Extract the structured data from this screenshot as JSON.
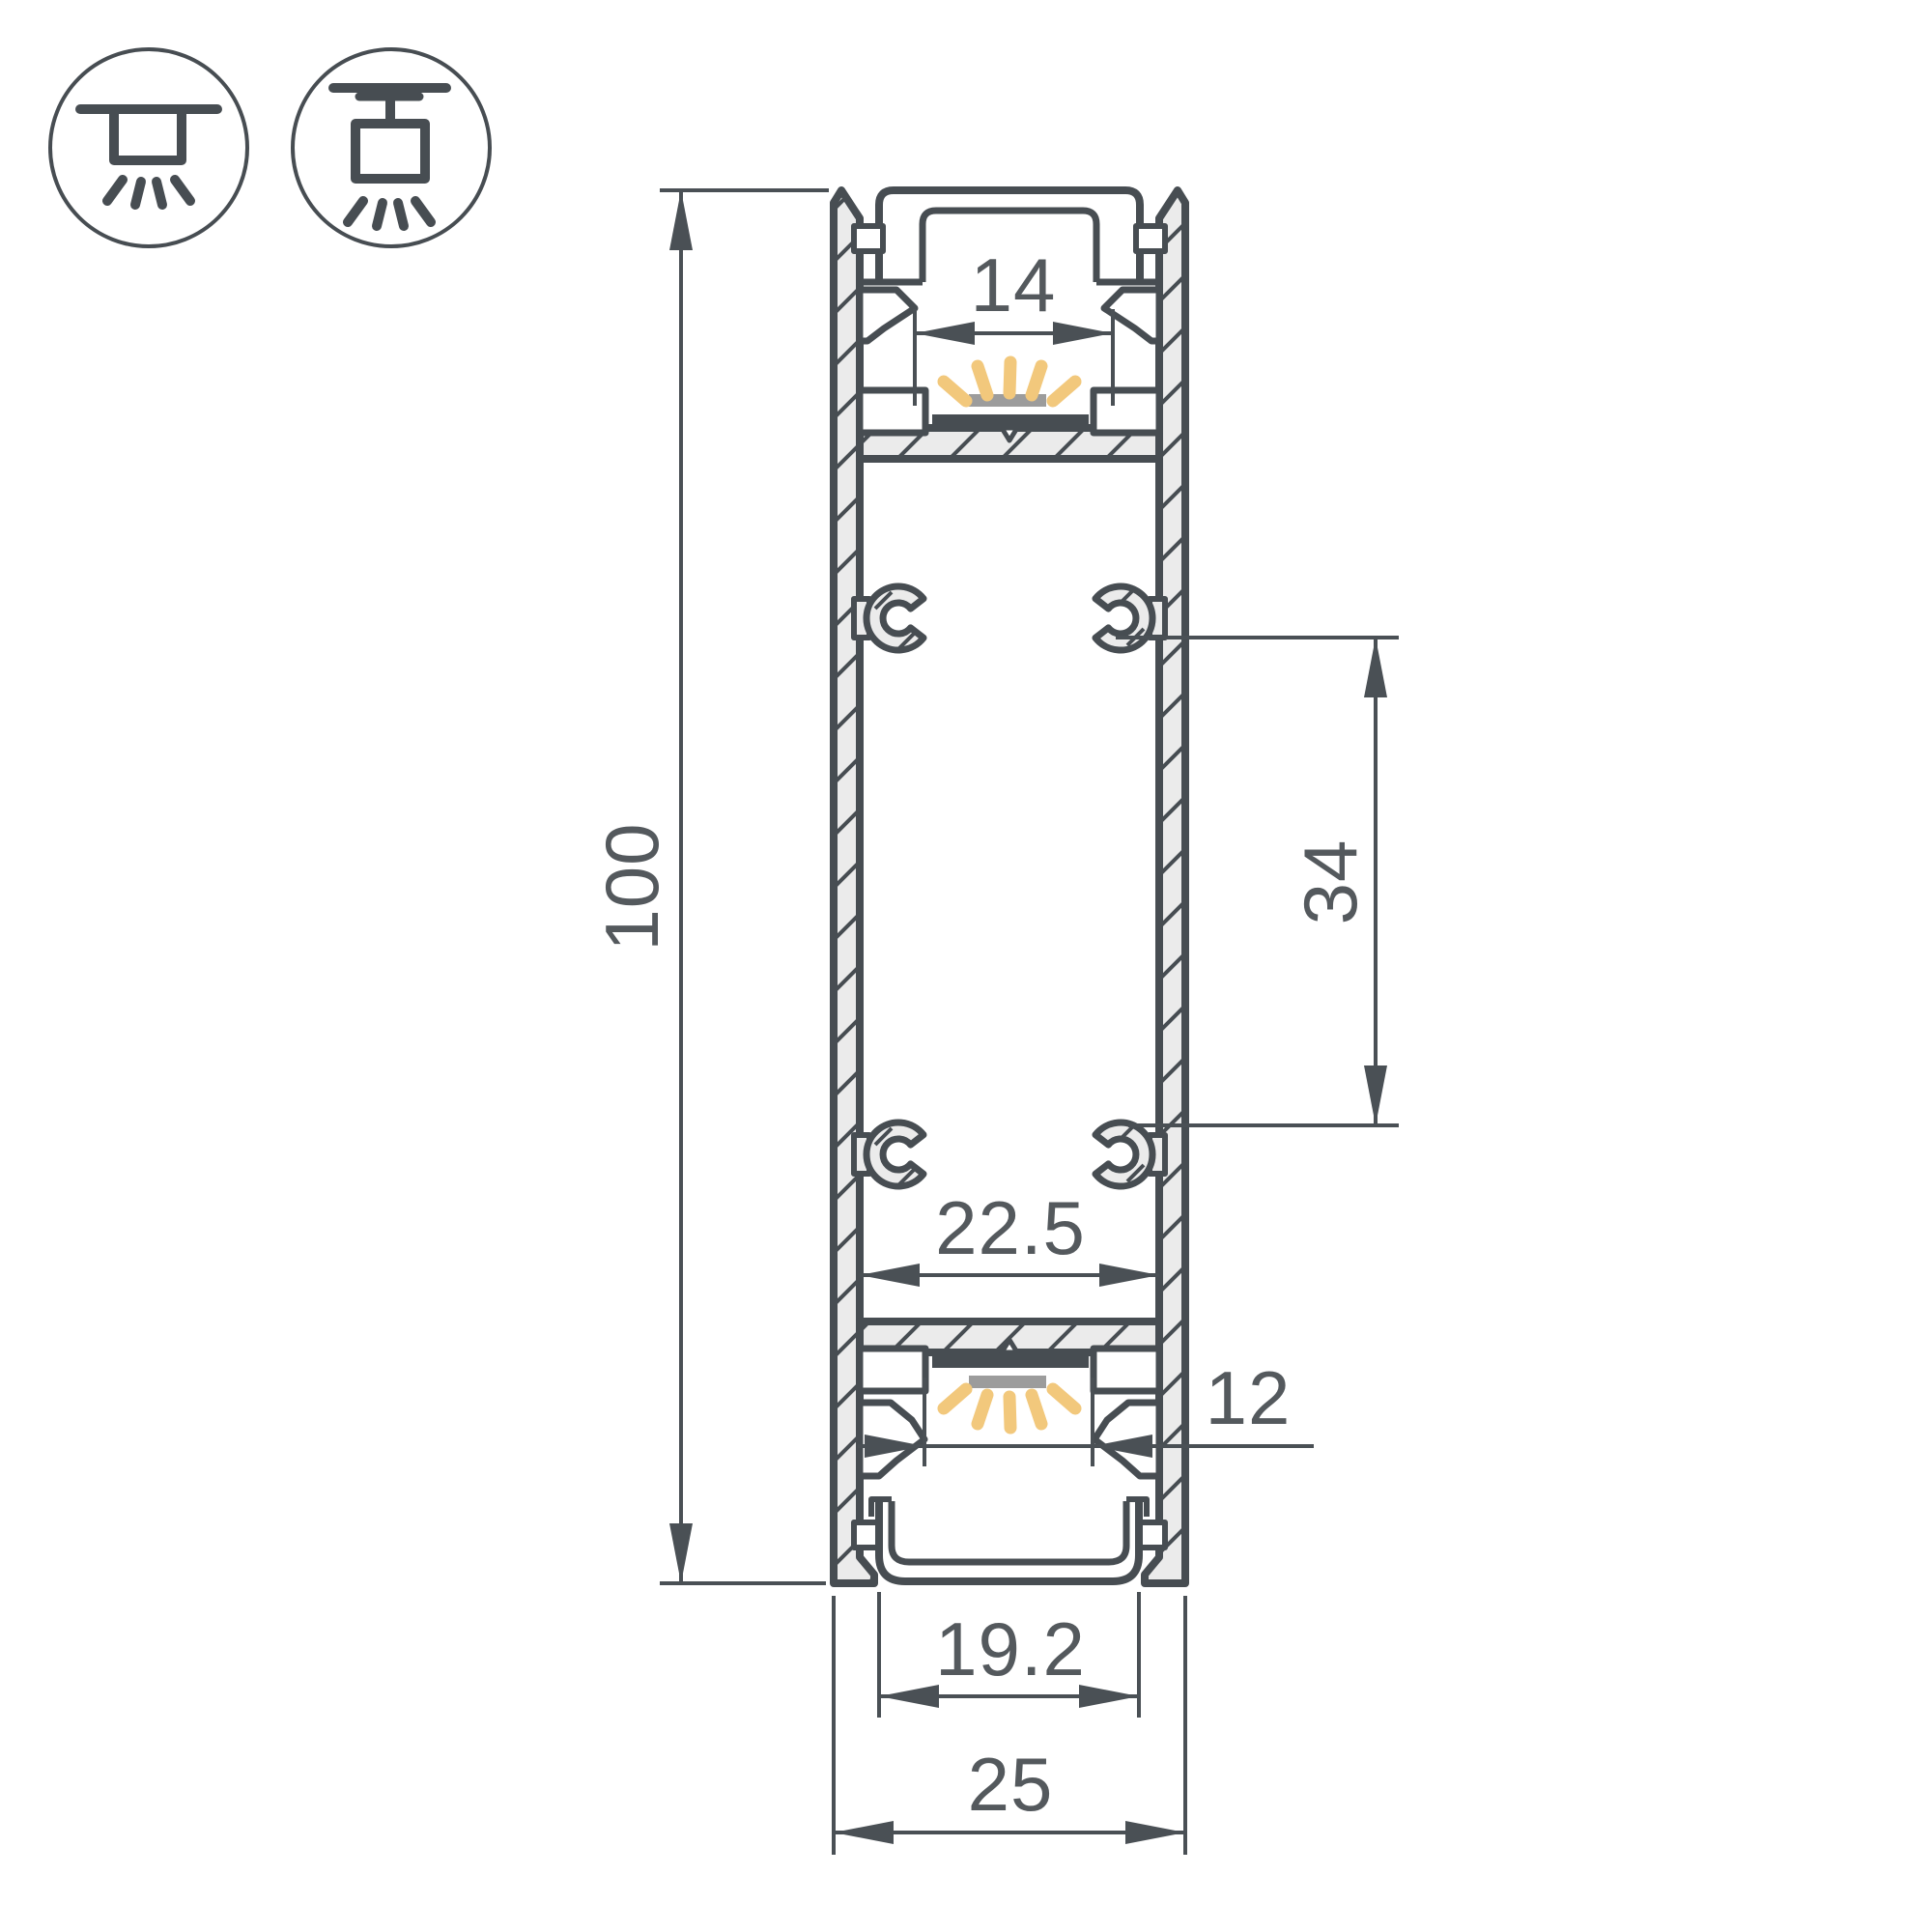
{
  "drawing": {
    "type": "technical-cross-section",
    "subject": "aluminium LED profile, double-sided (up/down light)",
    "dimensions": {
      "height": "100",
      "top_opening": "14",
      "mount_spacing": "34",
      "inner_width": "22.5",
      "bottom_opening": "12",
      "cover_width": "19.2",
      "overall_width": "25"
    },
    "icons": [
      {
        "name": "recessed-mount-icon"
      },
      {
        "name": "surface-mount-icon"
      }
    ],
    "colors": {
      "line": "#474d52",
      "cut_fill": "#ebebeb",
      "text": "#54595d",
      "glow": "#f2c87c",
      "led_diffuser": "#9c9c9c",
      "background": "#ffffff"
    }
  }
}
